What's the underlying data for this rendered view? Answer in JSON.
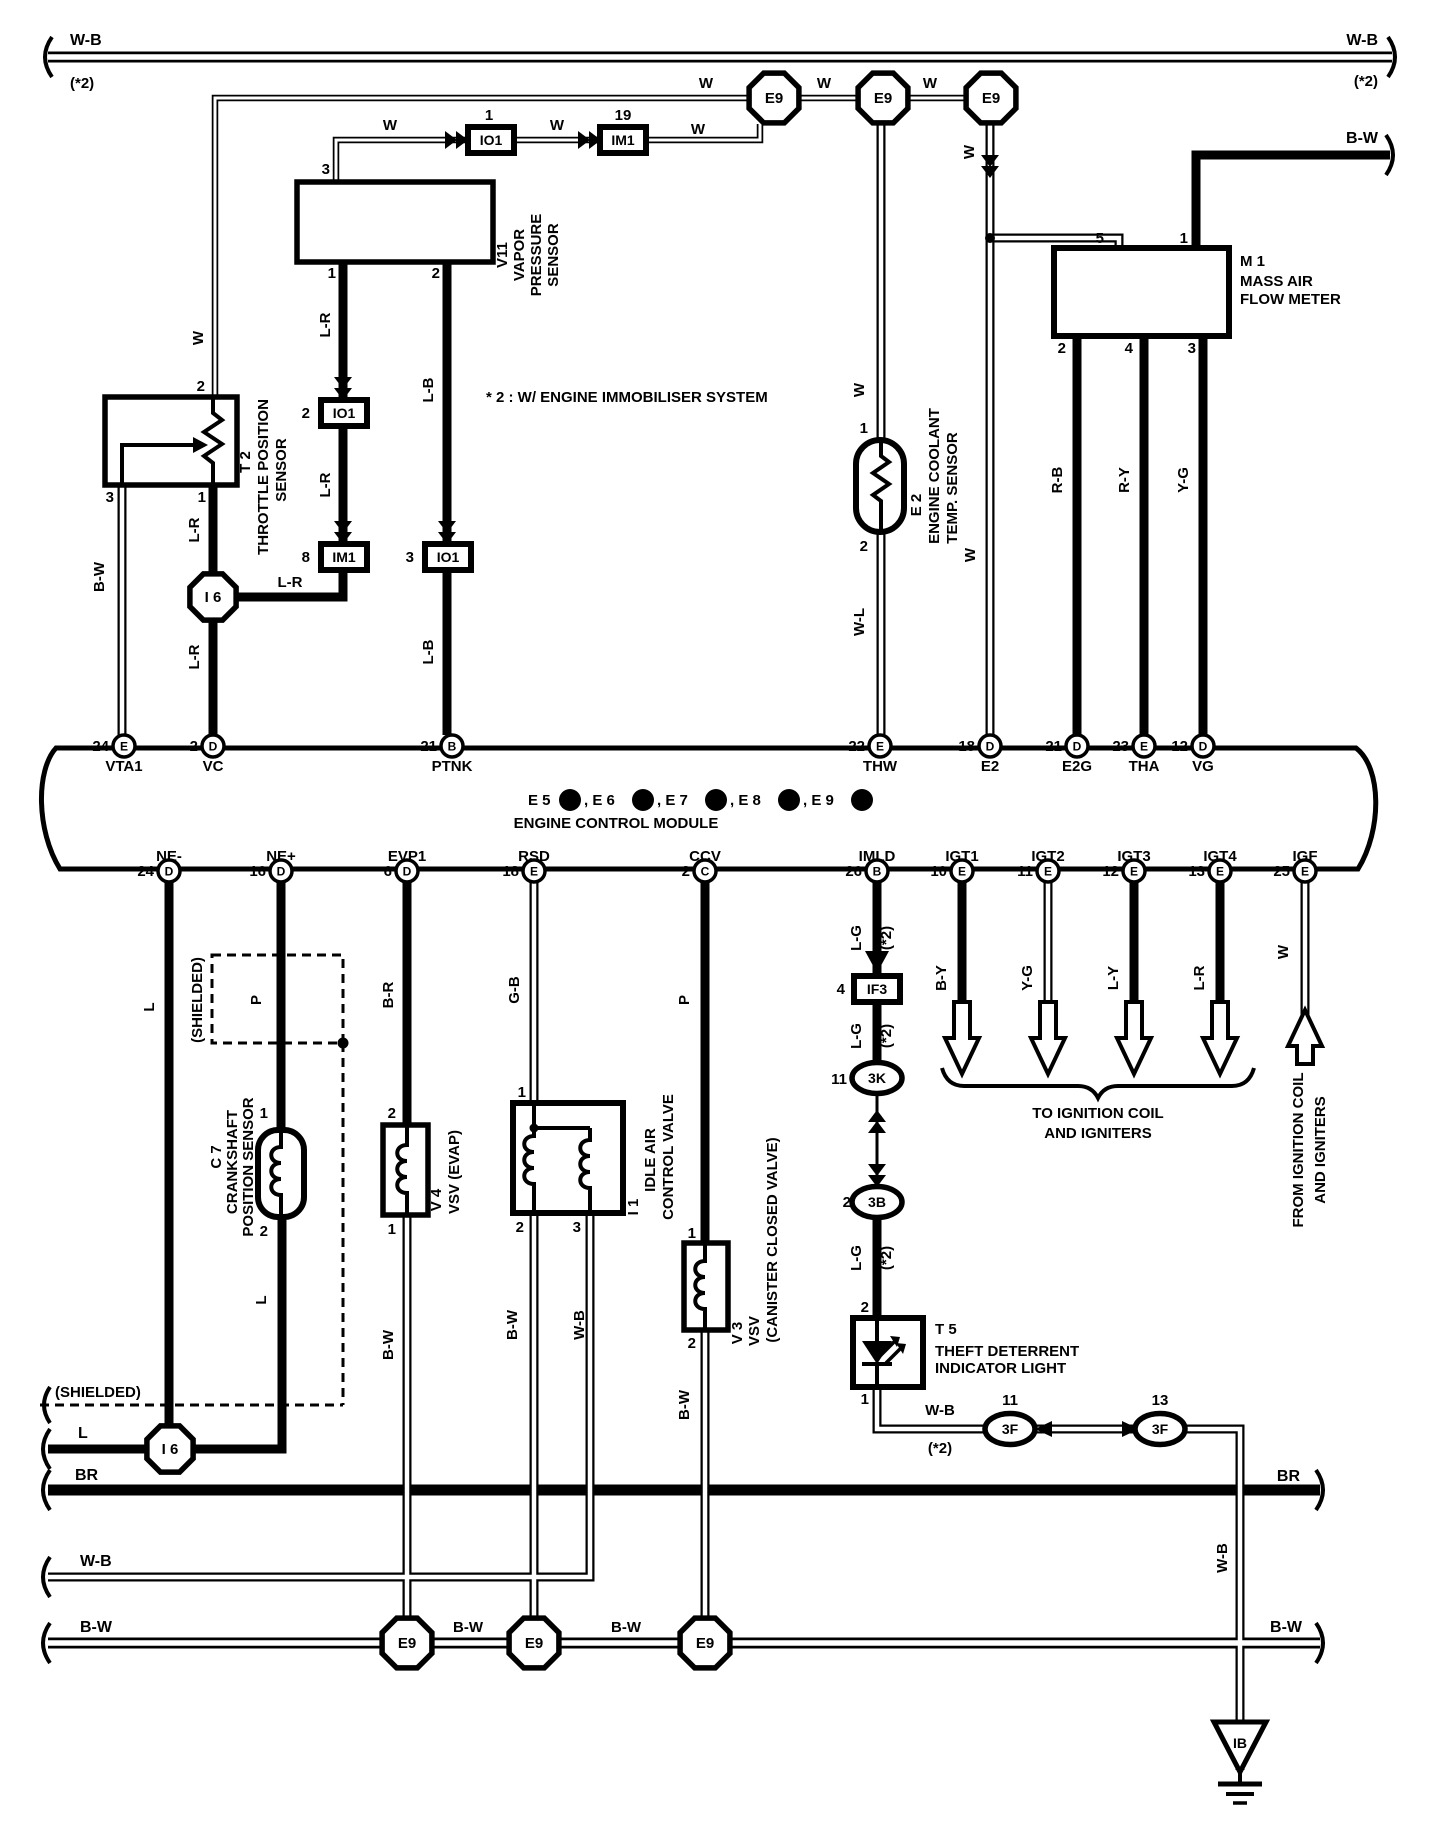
{
  "title": "Engine control module wiring diagram",
  "ecm": {
    "connector_row": [
      {
        "t": "E 5",
        "x": 528
      },
      {
        "t": ",  E 6",
        "x": 584
      },
      {
        "t": ",  E 7",
        "x": 657
      },
      {
        "t": ",  E 8",
        "x": 730
      },
      {
        "t": ",  E 9",
        "x": 803
      }
    ],
    "connector_ids": [
      {
        "letter": "A",
        "x": 570
      },
      {
        "letter": "B",
        "x": 643
      },
      {
        "letter": "C",
        "x": 716
      },
      {
        "letter": "D",
        "x": 789
      },
      {
        "letter": "E",
        "x": 862
      }
    ],
    "name": "ENGINE CONTROL MODULE"
  },
  "terminals_top": [
    {
      "x": 124,
      "letter": "E",
      "num": "24",
      "label": "VTA1"
    },
    {
      "x": 213,
      "letter": "D",
      "num": "2",
      "label": "VC"
    },
    {
      "x": 452,
      "letter": "B",
      "num": "21",
      "label": "PTNK"
    },
    {
      "x": 880,
      "letter": "E",
      "num": "22",
      "label": "THW"
    },
    {
      "x": 990,
      "letter": "D",
      "num": "18",
      "label": "E2"
    },
    {
      "x": 1077,
      "letter": "D",
      "num": "21",
      "label": "E2G"
    },
    {
      "x": 1144,
      "letter": "E",
      "num": "23",
      "label": "THA"
    },
    {
      "x": 1203,
      "letter": "D",
      "num": "12",
      "label": "VG"
    }
  ],
  "terminals_bottom": [
    {
      "x": 169,
      "letter": "D",
      "num": "24",
      "label": "NE-"
    },
    {
      "x": 281,
      "letter": "D",
      "num": "16",
      "label": "NE+"
    },
    {
      "x": 407,
      "letter": "D",
      "num": "6",
      "label": "EVP1"
    },
    {
      "x": 534,
      "letter": "E",
      "num": "18",
      "label": "RSD"
    },
    {
      "x": 705,
      "letter": "C",
      "num": "2",
      "label": "CCV"
    },
    {
      "x": 877,
      "letter": "B",
      "num": "26",
      "label": "IMLD"
    },
    {
      "x": 962,
      "letter": "E",
      "num": "10",
      "label": "IGT1"
    },
    {
      "x": 1048,
      "letter": "E",
      "num": "11",
      "label": "IGT2"
    },
    {
      "x": 1134,
      "letter": "E",
      "num": "12",
      "label": "IGT3"
    },
    {
      "x": 1220,
      "letter": "E",
      "num": "13",
      "label": "IGT4"
    },
    {
      "x": 1305,
      "letter": "E",
      "num": "25",
      "label": "IGF"
    }
  ],
  "connectors": [
    {
      "type": "oct",
      "t": "E9",
      "x": 774,
      "y": 98,
      "r": 27
    },
    {
      "type": "oct",
      "t": "E9",
      "x": 883,
      "y": 98,
      "r": 27
    },
    {
      "type": "oct",
      "t": "E9",
      "x": 991,
      "y": 98,
      "r": 27
    },
    {
      "type": "oct",
      "t": "I 6",
      "x": 213,
      "y": 597,
      "r": 25
    },
    {
      "type": "oct",
      "t": "I 6",
      "x": 170,
      "y": 1449,
      "r": 25
    },
    {
      "type": "oct",
      "t": "E9",
      "x": 407,
      "y": 1643,
      "r": 27
    },
    {
      "type": "oct",
      "t": "E9",
      "x": 534,
      "y": 1643,
      "r": 27
    },
    {
      "type": "oct",
      "t": "E9",
      "x": 705,
      "y": 1643,
      "r": 27
    },
    {
      "type": "box",
      "t": "IO1",
      "x": 491,
      "y": 140
    },
    {
      "type": "box",
      "t": "IM1",
      "x": 623,
      "y": 140
    },
    {
      "type": "box",
      "t": "IO1",
      "x": 344,
      "y": 413
    },
    {
      "type": "box",
      "t": "IM1",
      "x": 344,
      "y": 557
    },
    {
      "type": "box",
      "t": "IO1",
      "x": 448,
      "y": 557
    },
    {
      "type": "box",
      "t": "IF3",
      "x": 877,
      "y": 989
    },
    {
      "type": "oval",
      "t": "3K",
      "x": 877,
      "y": 1078
    },
    {
      "type": "oval",
      "t": "3B",
      "x": 877,
      "y": 1202
    },
    {
      "type": "oval",
      "t": "3F",
      "x": 1010,
      "y": 1429
    },
    {
      "type": "oval",
      "t": "3F",
      "x": 1160,
      "y": 1429
    },
    {
      "type": "gnd",
      "t": "IB",
      "x": 1240,
      "y": 1722
    }
  ],
  "labels": [
    {
      "n": "rail-wb-top-left",
      "t": "W-B",
      "x": 70,
      "y": 45,
      "a": "start",
      "s": 16
    },
    {
      "n": "rail-wb-top-left-note",
      "t": "(*2)",
      "x": 70,
      "y": 88,
      "a": "start"
    },
    {
      "n": "rail-wb-top-right",
      "t": "W-B",
      "x": 1378,
      "y": 45,
      "a": "end",
      "s": 16
    },
    {
      "n": "rail-wb-top-right-note",
      "t": "(*2)",
      "x": 1378,
      "y": 86,
      "a": "end"
    },
    {
      "n": "rail-bw-top-right",
      "t": "B-W",
      "x": 1378,
      "y": 143,
      "a": "end",
      "s": 16
    },
    {
      "n": "note-immobiliser",
      "t": "* 2 : W/ ENGINE IMMOBILISER SYSTEM",
      "x": 486,
      "y": 402,
      "a": "start"
    },
    {
      "n": "wire-w-1",
      "t": "W",
      "x": 390,
      "y": 130
    },
    {
      "n": "wire-w-2",
      "t": "W",
      "x": 557,
      "y": 130
    },
    {
      "n": "wire-w-3",
      "t": "W",
      "x": 698,
      "y": 134
    },
    {
      "n": "wire-w-4",
      "t": "W",
      "x": 706,
      "y": 88
    },
    {
      "n": "wire-w-5",
      "t": "W",
      "x": 824,
      "y": 88
    },
    {
      "n": "wire-w-6",
      "t": "W",
      "x": 930,
      "y": 88
    },
    {
      "n": "wire-w-t2",
      "t": "W",
      "x": 203,
      "y": 338,
      "r": 1
    },
    {
      "n": "pin-t2-2",
      "t": "2",
      "x": 205,
      "y": 391,
      "a": "end"
    },
    {
      "n": "pin-v11-3",
      "t": "3",
      "x": 330,
      "y": 174,
      "a": "end"
    },
    {
      "n": "pin-io1-1",
      "t": "1",
      "x": 489,
      "y": 120
    },
    {
      "n": "pin-im1-19",
      "t": "19",
      "x": 623,
      "y": 120
    },
    {
      "n": "pin-v11-1",
      "t": "1",
      "x": 336,
      "y": 278,
      "a": "end"
    },
    {
      "n": "pin-v11-2",
      "t": "2",
      "x": 440,
      "y": 278,
      "a": "end"
    },
    {
      "n": "wire-lr-1",
      "t": "L-R",
      "x": 330,
      "y": 325,
      "r": 1
    },
    {
      "n": "wire-lb-1",
      "t": "L-B",
      "x": 433,
      "y": 390,
      "r": 1
    },
    {
      "n": "pin-io1-2",
      "t": "2",
      "x": 310,
      "y": 418,
      "a": "end"
    },
    {
      "n": "wire-lr-2",
      "t": "L-R",
      "x": 330,
      "y": 485,
      "r": 1
    },
    {
      "n": "pin-im1-8",
      "t": "8",
      "x": 310,
      "y": 562,
      "a": "end"
    },
    {
      "n": "pin-io1-3",
      "t": "3",
      "x": 414,
      "y": 562,
      "a": "end"
    },
    {
      "n": "wire-lb-2",
      "t": "L-B",
      "x": 433,
      "y": 652,
      "r": 1
    },
    {
      "n": "wire-lr-3",
      "t": "L-R",
      "x": 199,
      "y": 530,
      "r": 1
    },
    {
      "n": "pin-t2-1",
      "t": "1",
      "x": 206,
      "y": 502,
      "a": "end"
    },
    {
      "n": "pin-t2-3",
      "t": "3",
      "x": 114,
      "y": 502,
      "a": "end"
    },
    {
      "n": "wire-bw-vta1",
      "t": "B-W",
      "x": 104,
      "y": 577,
      "r": 1
    },
    {
      "n": "wire-lr-i6",
      "t": "L-R",
      "x": 290,
      "y": 587
    },
    {
      "n": "wire-lr-4",
      "t": "L-R",
      "x": 199,
      "y": 657,
      "r": 1
    },
    {
      "n": "wire-w-e2sens",
      "t": "W",
      "x": 864,
      "y": 390,
      "r": 1
    },
    {
      "n": "pin-e2-1",
      "t": "1",
      "x": 868,
      "y": 433,
      "a": "end"
    },
    {
      "n": "pin-e2-2",
      "t": "2",
      "x": 868,
      "y": 551,
      "a": "end"
    },
    {
      "n": "wire-wl",
      "t": "W-L",
      "x": 864,
      "y": 622,
      "r": 1
    },
    {
      "n": "wire-w-e93",
      "t": "W",
      "x": 974,
      "y": 152,
      "r": 1
    },
    {
      "n": "wire-w-e2t",
      "t": "W",
      "x": 975,
      "y": 555,
      "r": 1
    },
    {
      "n": "pin-m1-5",
      "t": "5",
      "x": 1104,
      "y": 243,
      "a": "end"
    },
    {
      "n": "pin-m1-1",
      "t": "1",
      "x": 1188,
      "y": 243,
      "a": "end"
    },
    {
      "n": "pin-m1-2",
      "t": "2",
      "x": 1066,
      "y": 353,
      "a": "end"
    },
    {
      "n": "pin-m1-4",
      "t": "4",
      "x": 1133,
      "y": 353,
      "a": "end"
    },
    {
      "n": "pin-m1-3",
      "t": "3",
      "x": 1196,
      "y": 353,
      "a": "end"
    },
    {
      "n": "wire-rb",
      "t": "R-B",
      "x": 1062,
      "y": 480,
      "r": 1
    },
    {
      "n": "wire-ry",
      "t": "R-Y",
      "x": 1129,
      "y": 480,
      "r": 1
    },
    {
      "n": "wire-yg-1",
      "t": "Y-G",
      "x": 1188,
      "y": 480,
      "r": 1
    },
    {
      "n": "comp-m1-id",
      "t": "M 1",
      "x": 1240,
      "y": 266,
      "a": "start"
    },
    {
      "n": "comp-m1-l1",
      "t": "MASS AIR",
      "x": 1240,
      "y": 286,
      "a": "start"
    },
    {
      "n": "comp-m1-l2",
      "t": "FLOW METER",
      "x": 1240,
      "y": 304,
      "a": "start"
    },
    {
      "n": "comp-t2-id",
      "t": "T 2",
      "x": 250,
      "y": 462,
      "r": 1
    },
    {
      "n": "comp-t2-l1",
      "t": "THROTTLE POSITION",
      "x": 268,
      "y": 477,
      "r": 1
    },
    {
      "n": "comp-t2-l2",
      "t": "SENSOR",
      "x": 286,
      "y": 470,
      "r": 1
    },
    {
      "n": "comp-v11-id",
      "t": "V11",
      "x": 507,
      "y": 255,
      "r": 1
    },
    {
      "n": "comp-v11-l1",
      "t": "VAPOR",
      "x": 524,
      "y": 255,
      "r": 1
    },
    {
      "n": "comp-v11-l2",
      "t": "PRESSURE",
      "x": 541,
      "y": 255,
      "r": 1
    },
    {
      "n": "comp-v11-l3",
      "t": "SENSOR",
      "x": 558,
      "y": 255,
      "r": 1
    },
    {
      "n": "comp-e2-id",
      "t": "E 2",
      "x": 921,
      "y": 505,
      "r": 1
    },
    {
      "n": "comp-e2-l1",
      "t": "ENGINE COOLANT",
      "x": 939,
      "y": 476,
      "r": 1
    },
    {
      "n": "comp-e2-l2",
      "t": "TEMP. SENSOR",
      "x": 957,
      "y": 488,
      "r": 1
    },
    {
      "n": "ecm-name",
      "t": "ENGINE CONTROL MODULE",
      "x": 616,
      "y": 828
    },
    {
      "n": "wire-l-ne",
      "t": "L",
      "x": 154,
      "y": 1007,
      "r": 1
    },
    {
      "n": "wire-p-ne",
      "t": "P",
      "x": 261,
      "y": 1000,
      "r": 1
    },
    {
      "n": "wire-br-evp1",
      "t": "B-R",
      "x": 393,
      "y": 995,
      "r": 1
    },
    {
      "n": "wire-gb-rsd",
      "t": "G-B",
      "x": 519,
      "y": 990,
      "r": 1
    },
    {
      "n": "wire-p-ccv",
      "t": "P",
      "x": 689,
      "y": 1000,
      "r": 1
    },
    {
      "n": "wire-lg-1",
      "t": "L-G",
      "x": 861,
      "y": 938,
      "r": 1
    },
    {
      "n": "wire-lg-1n",
      "t": "(*2)",
      "x": 891,
      "y": 938,
      "r": 1
    },
    {
      "n": "wire-by",
      "t": "B-Y",
      "x": 946,
      "y": 978,
      "r": 1
    },
    {
      "n": "wire-yg-2",
      "t": "Y-G",
      "x": 1032,
      "y": 978,
      "r": 1
    },
    {
      "n": "wire-ly",
      "t": "L-Y",
      "x": 1118,
      "y": 978,
      "r": 1
    },
    {
      "n": "wire-lr-igt4",
      "t": "L-R",
      "x": 1204,
      "y": 978,
      "r": 1
    },
    {
      "n": "wire-w-igf",
      "t": "W",
      "x": 1288,
      "y": 952,
      "r": 1
    },
    {
      "n": "pin-if3-4",
      "t": "4",
      "x": 845,
      "y": 994,
      "a": "end"
    },
    {
      "n": "wire-lg-2",
      "t": "L-G",
      "x": 861,
      "y": 1036,
      "r": 1
    },
    {
      "n": "wire-lg-2n",
      "t": "(*2)",
      "x": 891,
      "y": 1036,
      "r": 1
    },
    {
      "n": "pin-3k-11",
      "t": "11",
      "x": 847,
      "y": 1084,
      "a": "end"
    },
    {
      "n": "pin-3b-2",
      "t": "2",
      "x": 851,
      "y": 1207,
      "a": "end"
    },
    {
      "n": "wire-lg-3",
      "t": "L-G",
      "x": 861,
      "y": 1258,
      "r": 1
    },
    {
      "n": "wire-lg-3n",
      "t": "(*2)",
      "x": 891,
      "y": 1258,
      "r": 1
    },
    {
      "n": "pin-t5-2",
      "t": "2",
      "x": 869,
      "y": 1312,
      "a": "end"
    },
    {
      "n": "pin-t5-1",
      "t": "1",
      "x": 869,
      "y": 1404,
      "a": "end"
    },
    {
      "n": "wire-wb-t5",
      "t": "W-B",
      "x": 940,
      "y": 1415
    },
    {
      "n": "wire-wb-t5n",
      "t": "(*2)",
      "x": 940,
      "y": 1453
    },
    {
      "n": "pin-3f-11",
      "t": "11",
      "x": 1010,
      "y": 1405
    },
    {
      "n": "pin-3f-13",
      "t": "13",
      "x": 1160,
      "y": 1405
    },
    {
      "n": "note-to-ign-1",
      "t": "TO IGNITION COIL",
      "x": 1098,
      "y": 1118
    },
    {
      "n": "note-to-ign-2",
      "t": "AND IGNITERS",
      "x": 1098,
      "y": 1138
    },
    {
      "n": "note-from-ign-1",
      "t": "FROM IGNITION COIL",
      "x": 1303,
      "y": 1150,
      "r": 1
    },
    {
      "n": "note-from-ign-2",
      "t": "AND IGNITERS",
      "x": 1325,
      "y": 1150,
      "r": 1
    },
    {
      "n": "wire-wb-drop",
      "t": "W-B",
      "x": 1227,
      "y": 1558,
      "r": 1
    },
    {
      "n": "comp-c7-id",
      "t": "C 7",
      "x": 221,
      "y": 1157,
      "r": 1
    },
    {
      "n": "comp-c7-l1",
      "t": "CRANKSHAFT",
      "x": 237,
      "y": 1162,
      "r": 1
    },
    {
      "n": "comp-c7-l2",
      "t": "POSITION SENSOR",
      "x": 253,
      "y": 1167,
      "r": 1
    },
    {
      "n": "pin-c7-1",
      "t": "1",
      "x": 268,
      "y": 1118,
      "a": "end"
    },
    {
      "n": "pin-c7-2",
      "t": "2",
      "x": 268,
      "y": 1236,
      "a": "end"
    },
    {
      "n": "wire-l-c7",
      "t": "L",
      "x": 266,
      "y": 1300,
      "r": 1
    },
    {
      "n": "shield-label-1",
      "t": "(SHIELDED)",
      "x": 202,
      "y": 1000,
      "r": 1
    },
    {
      "n": "pin-v4-2",
      "t": "2",
      "x": 396,
      "y": 1118,
      "a": "end"
    },
    {
      "n": "pin-v4-1",
      "t": "1",
      "x": 396,
      "y": 1234,
      "a": "end"
    },
    {
      "n": "comp-v4-id",
      "t": "V 4",
      "x": 441,
      "y": 1200,
      "r": 1
    },
    {
      "n": "comp-v4-l1",
      "t": "VSV (EVAP)",
      "x": 459,
      "y": 1172,
      "r": 1
    },
    {
      "n": "wire-bw-v4",
      "t": "B-W",
      "x": 393,
      "y": 1345,
      "r": 1
    },
    {
      "n": "pin-i1-1",
      "t": "1",
      "x": 526,
      "y": 1097,
      "a": "end"
    },
    {
      "n": "pin-i1-2",
      "t": "2",
      "x": 524,
      "y": 1232,
      "a": "end"
    },
    {
      "n": "pin-i1-3",
      "t": "3",
      "x": 581,
      "y": 1232,
      "a": "end"
    },
    {
      "n": "comp-i1-id",
      "t": "I 1",
      "x": 638,
      "y": 1207,
      "r": 1
    },
    {
      "n": "comp-i1-l1",
      "t": "IDLE AIR",
      "x": 655,
      "y": 1160,
      "r": 1
    },
    {
      "n": "comp-i1-l2",
      "t": "CONTROL VALVE",
      "x": 673,
      "y": 1157,
      "r": 1
    },
    {
      "n": "wire-bw-i1",
      "t": "B-W",
      "x": 517,
      "y": 1325,
      "r": 1
    },
    {
      "n": "wire-wb-i1",
      "t": "W-B",
      "x": 584,
      "y": 1325,
      "r": 1
    },
    {
      "n": "pin-v3-1",
      "t": "1",
      "x": 696,
      "y": 1238,
      "a": "end"
    },
    {
      "n": "pin-v3-2",
      "t": "2",
      "x": 696,
      "y": 1348,
      "a": "end"
    },
    {
      "n": "comp-v3-id",
      "t": "V 3",
      "x": 742,
      "y": 1333,
      "r": 1
    },
    {
      "n": "comp-v3-l1",
      "t": "VSV",
      "x": 759,
      "y": 1331,
      "r": 1
    },
    {
      "n": "comp-v3-l2",
      "t": "(CANISTER CLOSED VALVE)",
      "x": 777,
      "y": 1240,
      "r": 1
    },
    {
      "n": "wire-bw-v3",
      "t": "B-W",
      "x": 689,
      "y": 1405,
      "r": 1
    },
    {
      "n": "comp-t5-id",
      "t": "T 5",
      "x": 935,
      "y": 1334,
      "a": "start"
    },
    {
      "n": "comp-t5-l1",
      "t": "THEFT DETERRENT",
      "x": 935,
      "y": 1356,
      "a": "start"
    },
    {
      "n": "comp-t5-l2",
      "t": "INDICATOR LIGHT",
      "x": 935,
      "y": 1373,
      "a": "start"
    },
    {
      "n": "rail-br-left",
      "t": "BR",
      "x": 75,
      "y": 1480,
      "a": "start",
      "s": 16
    },
    {
      "n": "rail-br-right",
      "t": "BR",
      "x": 1300,
      "y": 1481,
      "a": "end",
      "s": 16
    },
    {
      "n": "rail-wb-mid-left",
      "t": "W-B",
      "x": 80,
      "y": 1566,
      "a": "start",
      "s": 16
    },
    {
      "n": "rail-bw-bot-left",
      "t": "B-W",
      "x": 80,
      "y": 1632,
      "a": "start",
      "s": 16
    },
    {
      "n": "rail-bw-bot-m1",
      "t": "B-W",
      "x": 468,
      "y": 1632
    },
    {
      "n": "rail-bw-bot-m2",
      "t": "B-W",
      "x": 626,
      "y": 1632
    },
    {
      "n": "rail-bw-bot-right",
      "t": "B-W",
      "x": 1302,
      "y": 1632,
      "a": "end",
      "s": 16
    },
    {
      "n": "wire-l-stub",
      "t": "L",
      "x": 78,
      "y": 1438,
      "a": "start",
      "s": 16
    },
    {
      "n": "shield-label-2",
      "t": "(SHIELDED)",
      "x": 55,
      "y": 1397,
      "a": "start"
    }
  ]
}
